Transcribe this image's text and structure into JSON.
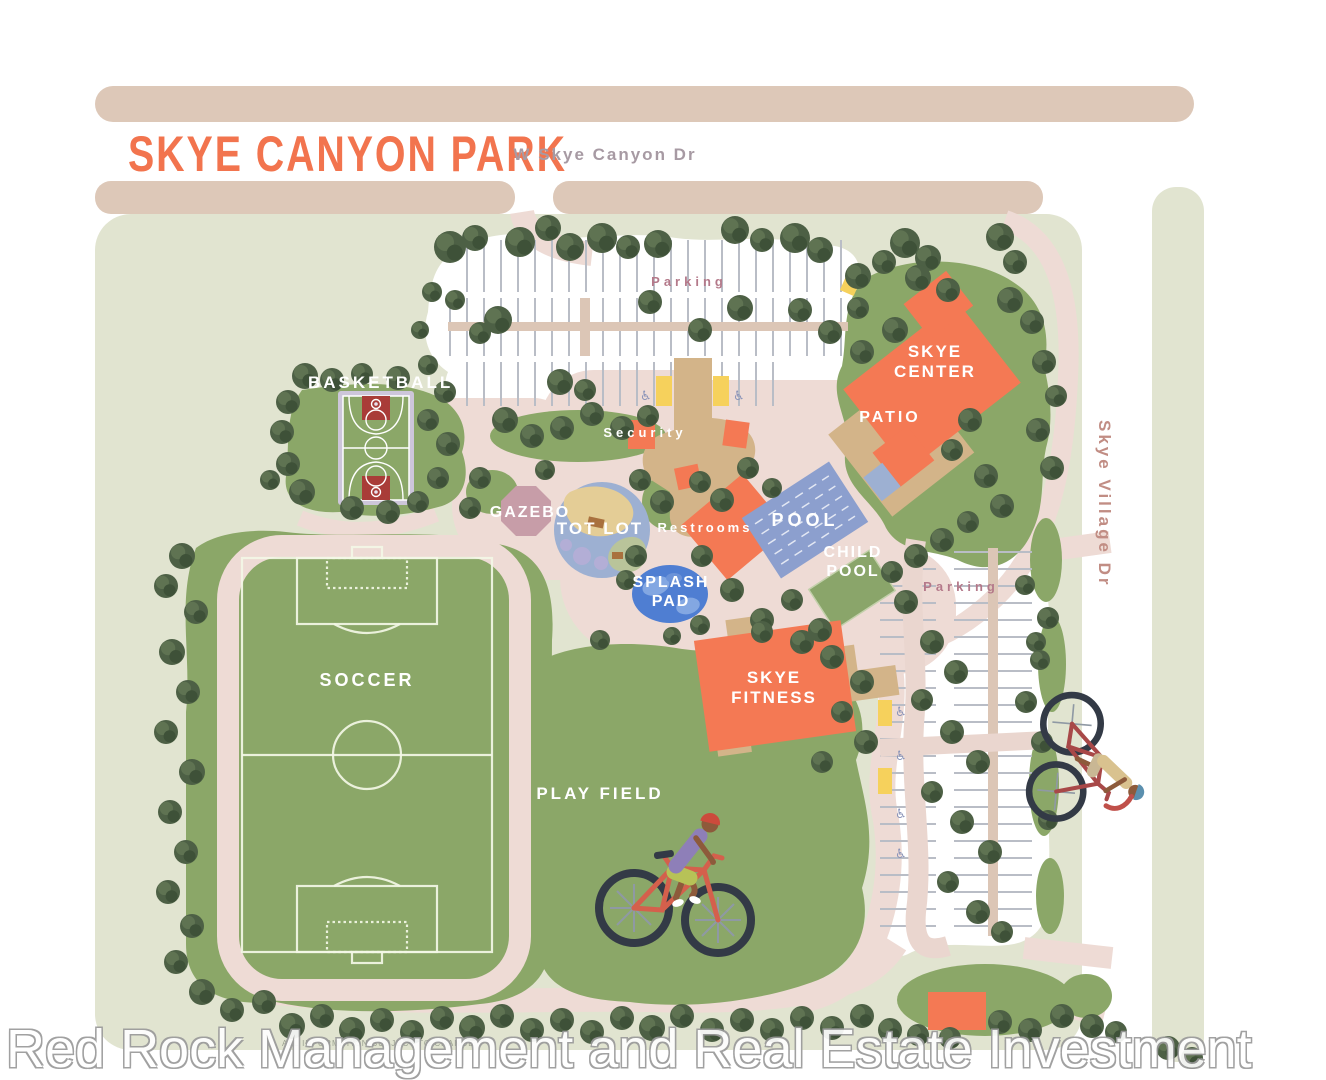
{
  "title": "SKYE CANYON PARK",
  "roads": {
    "north": "W Skye Canyon Dr",
    "east": "Skye Village Dr"
  },
  "labels": {
    "basketball": "BASKETBALL",
    "parking_north": "Parking",
    "parking_east": "Parking",
    "security": "Security",
    "gazebo": "GAZEBO",
    "tot_lot": "TOT LOT",
    "restrooms": "Restrooms",
    "pool": "POOL",
    "child_pool": "CHILD POOL",
    "splash_pad": "SPLASH PAD",
    "skye_center": "SKYE CENTER",
    "patio": "PATIO",
    "skye_fitness": "SKYE FITNESS",
    "soccer": "SOCCER",
    "play_field": "PLAY FIELD"
  },
  "watermark": "Red Rock Management and Real Estate Investment",
  "disclaimer": "ALL INFORMATION SUBJECT TO CHANGE",
  "icons": {
    "wheelchair": "♿"
  },
  "colors": {
    "title_orange": "#f2744e",
    "building_orange": "#f47954",
    "grass_green": "#8ba768",
    "tree_green": "#4d6045",
    "path_pink": "#eedbd5",
    "road_tan": "#ddc8b8",
    "ground_sage": "#e1e4d0",
    "plaza_tan": "#d3b489",
    "pool_blue": "#8c9fce",
    "splash_blue": "#4f7ed2",
    "gazebo_mauve": "#c79da8",
    "accessible_yellow": "#f6d15c",
    "road_label": "#a79aa3",
    "parking_label": "#b4798a"
  }
}
